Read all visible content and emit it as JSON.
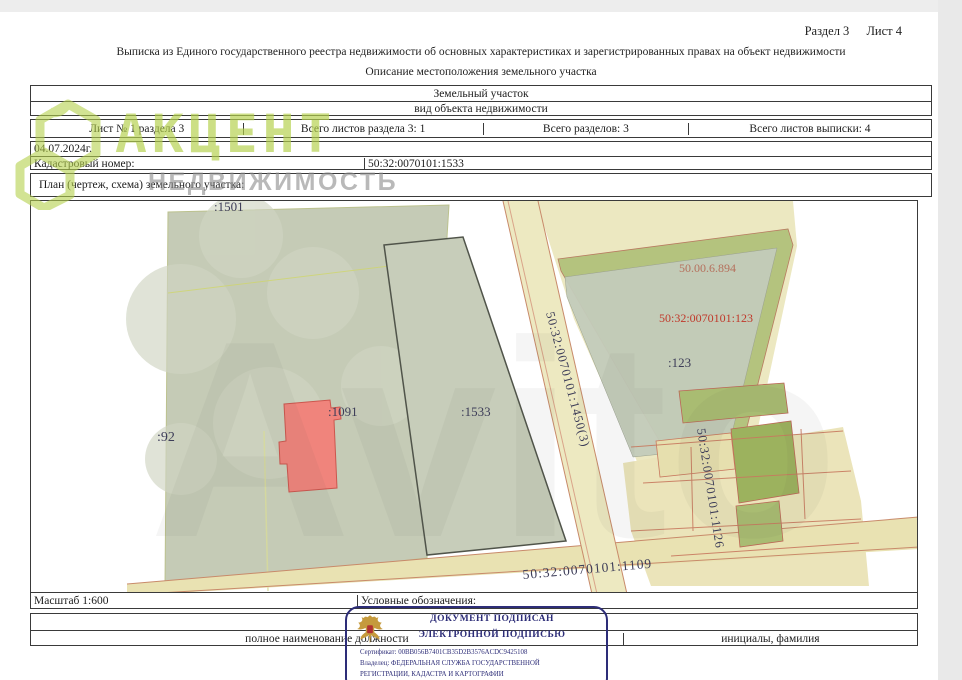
{
  "page": {
    "section_label": "Раздел 3",
    "sheet_label": "Лист 4",
    "title": "Выписка из Единого государственного реестра недвижимости об основных характеристиках и зарегистрированных правах на объект недвижимости",
    "subtitle": "Описание местоположения земельного участка"
  },
  "object_table": {
    "object_type": "Земельный участок",
    "object_type_caption": "вид объекта недвижимости"
  },
  "sheet_table": {
    "cells": [
      "Лист № 1 раздела 3",
      "Всего листов раздела 3: 1",
      "Всего разделов: 3",
      "Всего листов выписки: 4"
    ]
  },
  "meta_table": {
    "date": "04.07.2024г.",
    "cadastral_label": "Кадастровый номер:",
    "cadastral_number": "50:32:0070101:1533"
  },
  "plan": {
    "header": "План (чертеж, схема) земельного участка:",
    "scale_label": "Масштаб 1:600",
    "legend_label": "Условные обозначения:"
  },
  "map_labels": {
    "parcel_1501": ":1501",
    "parcel_92": ":92",
    "parcel_1091": ":1091",
    "parcel_1533": ":1533",
    "parcel_123": ":123",
    "cad_123_full": "50:32:0070101:123",
    "area_note": "50.00.6.894",
    "road_1450": "50:32:0070101:1450(3)",
    "road_1109": "50:32:0070101:1109",
    "cad_1126": "50:32:0070101:1126"
  },
  "signature_block": {
    "position_caption": "полное наименование должности",
    "name_caption": "инициалы, фамилия"
  },
  "stamp": {
    "line1": "ДОКУМЕНТ ПОДПИСАН",
    "line2": "ЭЛЕКТРОННОЙ ПОДПИСЬЮ",
    "certificate": "Сертификат: 00BB056B7401CB35D2B3576ACDC9425108",
    "owner_line1": "Владелец: ФЕДЕРАЛЬНАЯ СЛУЖБА ГОСУДАРСТВЕННОЙ",
    "owner_line2": "РЕГИСТРАЦИИ, КАДАСТРА И КАРТОГРАФИИ"
  },
  "watermarks": {
    "brand_title": "АКЦЕНТ",
    "brand_subtitle": "НЕДВИЖИМОСТЬ",
    "marketplace": "Avito"
  },
  "colors": {
    "brand_green": "#b5d14c",
    "stamp_navy": "#2d2d78",
    "parcel_green_gray": "#c5cbb6",
    "parcel_olive": "#a9bc72",
    "road_yellow": "#ede9c1",
    "building_red": "#f0847c",
    "label_navy": "#3d3d58",
    "label_red": "#c0392b"
  }
}
